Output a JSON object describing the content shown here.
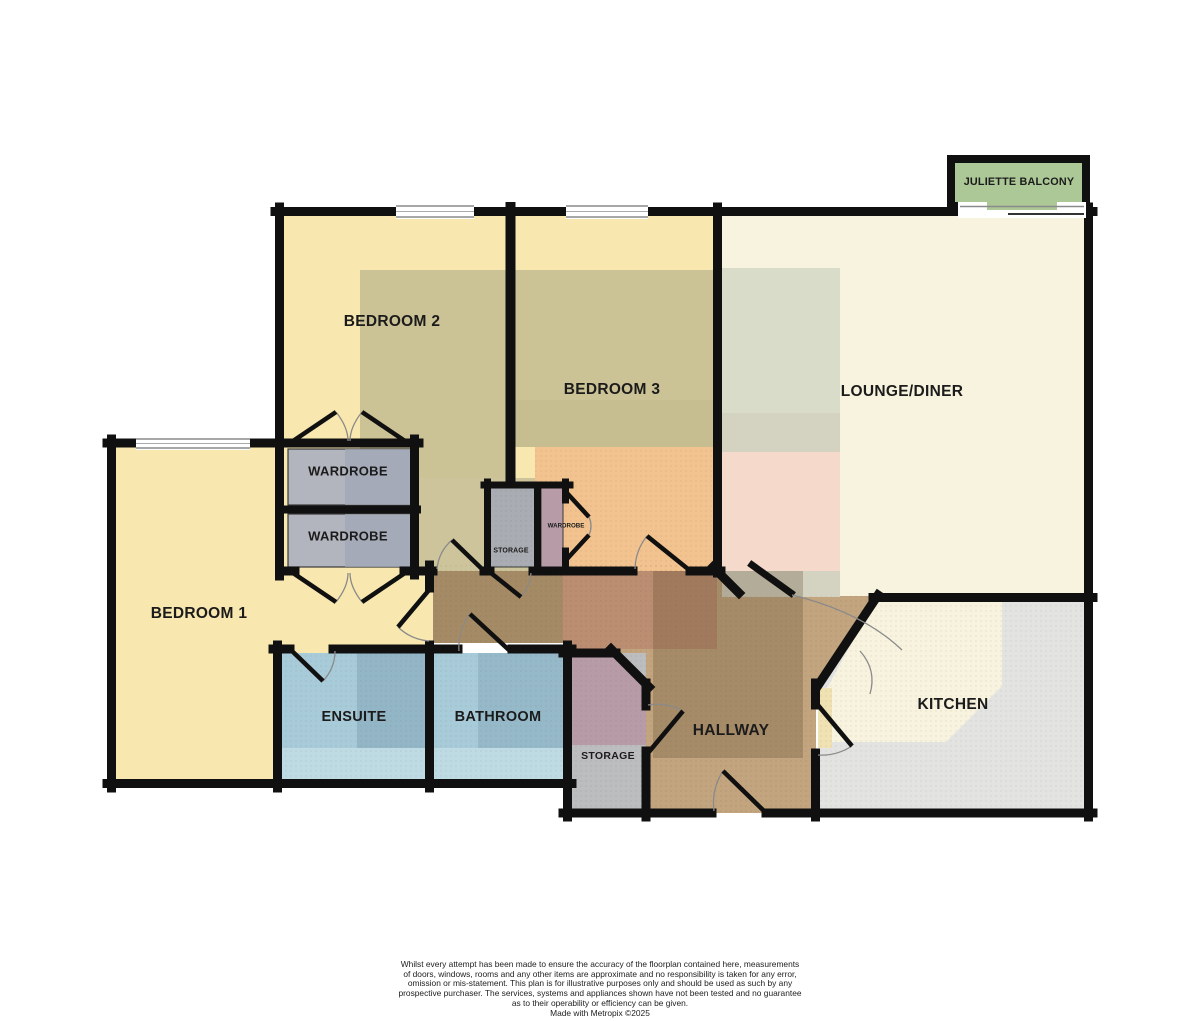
{
  "floorplan": {
    "rooms": [
      {
        "id": "bedroom2",
        "label": "BEDROOM 2"
      },
      {
        "id": "bedroom3",
        "label": "BEDROOM 3"
      },
      {
        "id": "lounge",
        "label": "LOUNGE/DINER"
      },
      {
        "id": "bedroom1",
        "label": "BEDROOM 1"
      },
      {
        "id": "wardrobe-top",
        "label": "WARDROBE"
      },
      {
        "id": "wardrobe-bottom",
        "label": "WARDROBE"
      },
      {
        "id": "wardrobe-small",
        "label": "WARDROBE"
      },
      {
        "id": "storage-mid",
        "label": "STORAGE"
      },
      {
        "id": "ensuite",
        "label": "ENSUITE"
      },
      {
        "id": "bathroom",
        "label": "BATHROOM"
      },
      {
        "id": "storage-bottom",
        "label": "STORAGE"
      },
      {
        "id": "hallway",
        "label": "HALLWAY"
      },
      {
        "id": "kitchen",
        "label": "KITCHEN"
      },
      {
        "id": "juliette-balcony",
        "label": "JULIETTE BALCONY"
      }
    ],
    "colors": {
      "wall": "#101010",
      "bedroom_yellow": "#F8E7AF",
      "olive": "#CBC295",
      "orange": "#F2C38F",
      "lounge_cream": "#F8F3DE",
      "sage": "#D8DCC8",
      "sage_gray": "#D4D2C1",
      "pink": "#F5D9CB",
      "bath_blue": "#A8CBD9",
      "bath_blue_dark": "#93B6C7",
      "bath_blue_light": "#BEDBE3",
      "unit_gray": "#B2B5BE",
      "unit_gray_dark": "#9FA7B4",
      "storage_gray": "#A9ACB2",
      "mauve": "#B79CA8",
      "hall_tan": "#C2A47E",
      "hall_salmon": "#BB8D71",
      "kitchen_gray": "#E3E4E2",
      "kitchen_cream": "#F8F3DE",
      "balcony_green": "#ACC897"
    },
    "disclaimer": {
      "lines": [
        "Whilst every attempt has been made to ensure the accuracy of the floorplan contained here, measurements",
        "of doors, windows, rooms and any other items are approximate and no responsibility is taken for any error,",
        "omission or mis-statement. This plan is for illustrative purposes only and should be used as such by any",
        "prospective purchaser. The services, systems and appliances shown have not been tested and no guarantee",
        "as to their operability or efficiency can be given.",
        "Made with Metropix ©2025"
      ]
    }
  }
}
